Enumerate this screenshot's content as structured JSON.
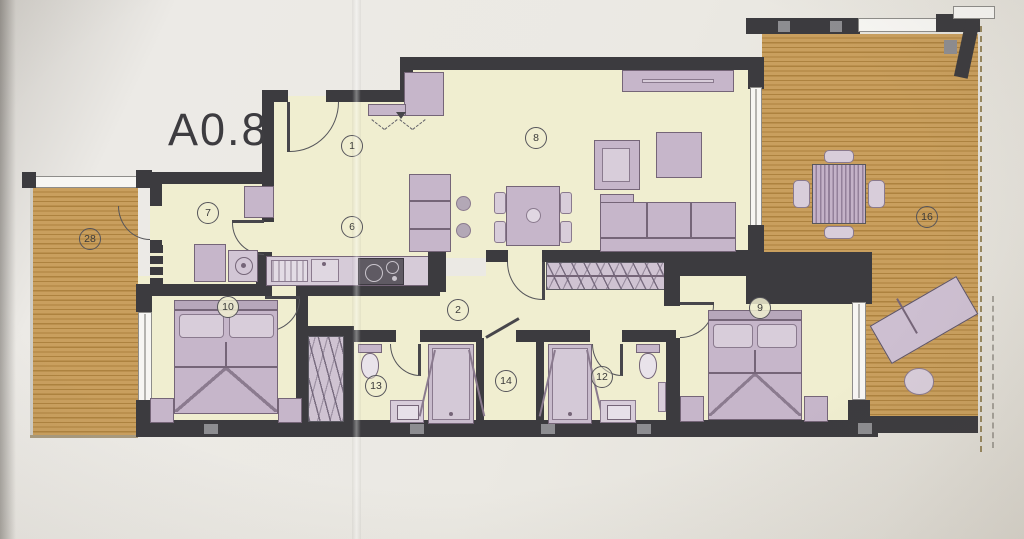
{
  "unit_label": "A0.8",
  "rooms": {
    "entrance": {
      "number": "1"
    },
    "hallway": {
      "number": "2"
    },
    "kitchen": {
      "number": "6"
    },
    "utility": {
      "number": "7"
    },
    "living_dining": {
      "number": "8"
    },
    "bedroom_2": {
      "number": "9"
    },
    "bedroom_1": {
      "number": "10"
    },
    "bathroom_2": {
      "number": "12"
    },
    "bathroom_1": {
      "number": "13"
    },
    "inner_hall": {
      "number": "14"
    },
    "terrace_main": {
      "number": "16"
    },
    "terrace_side": {
      "number": "28"
    }
  },
  "colors": {
    "wall": "#3c3b3f",
    "floor": "#f0eed0",
    "terrace_deck": "#c99f5e",
    "furniture": "#c6b6ca",
    "paper": "#e9e7e2"
  }
}
